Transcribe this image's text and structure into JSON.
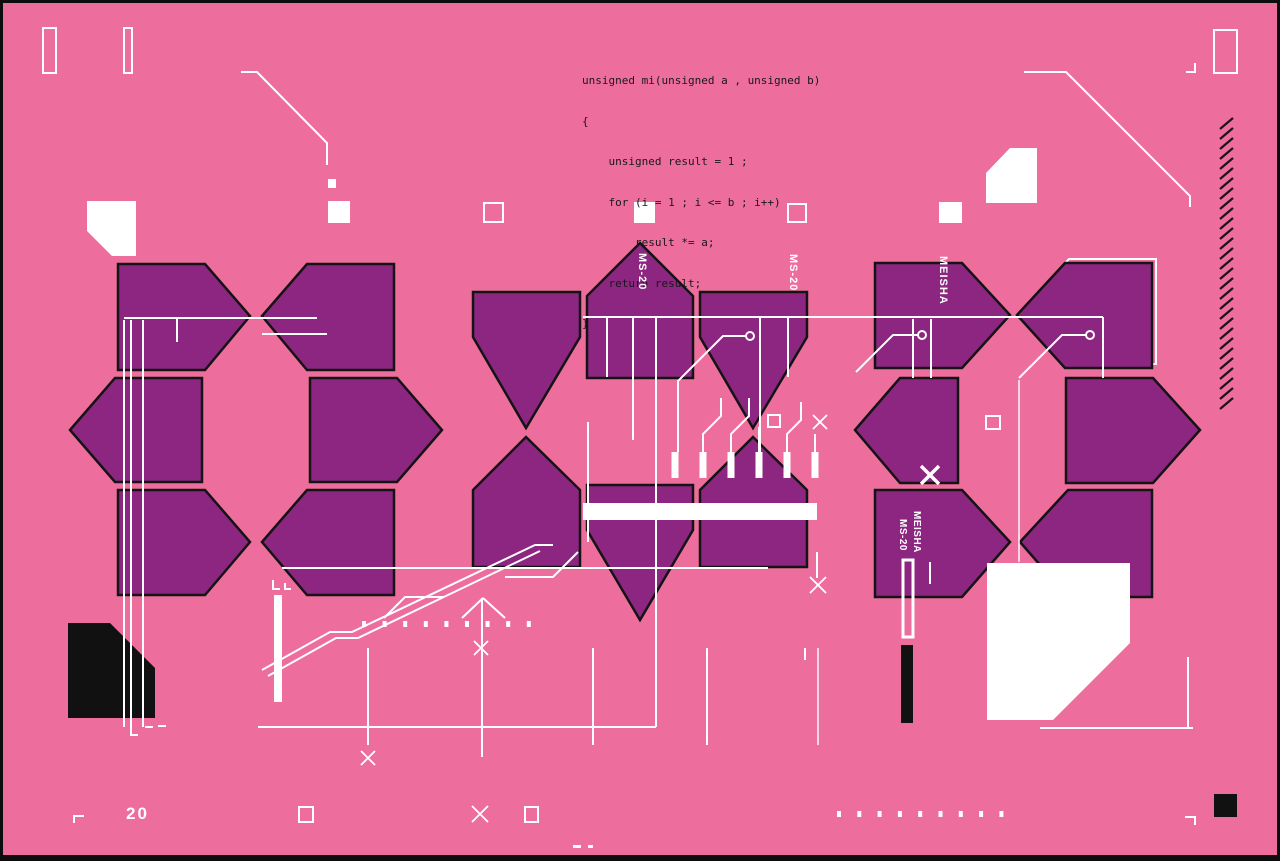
{
  "art": {
    "code_block": {
      "lines": [
        "unsigned mi(unsigned a , unsigned b)",
        "{",
        "    unsigned result = 1 ;",
        "    for (i = 1 ; i <= b ; i++)",
        "        result *= a;",
        "    return result;",
        "}"
      ]
    },
    "labels": {
      "synth_model": "MS-20",
      "synth_name": "MEISHA",
      "page_number": "20"
    }
  },
  "colors": {
    "background": "#ed6e9d",
    "shape_fill": "#8c2681",
    "shape_stroke": "#141414",
    "line_accent": "#ffffff",
    "ink": "#181818",
    "frame": "#0d0d0d",
    "hatch": "#1e1218"
  }
}
